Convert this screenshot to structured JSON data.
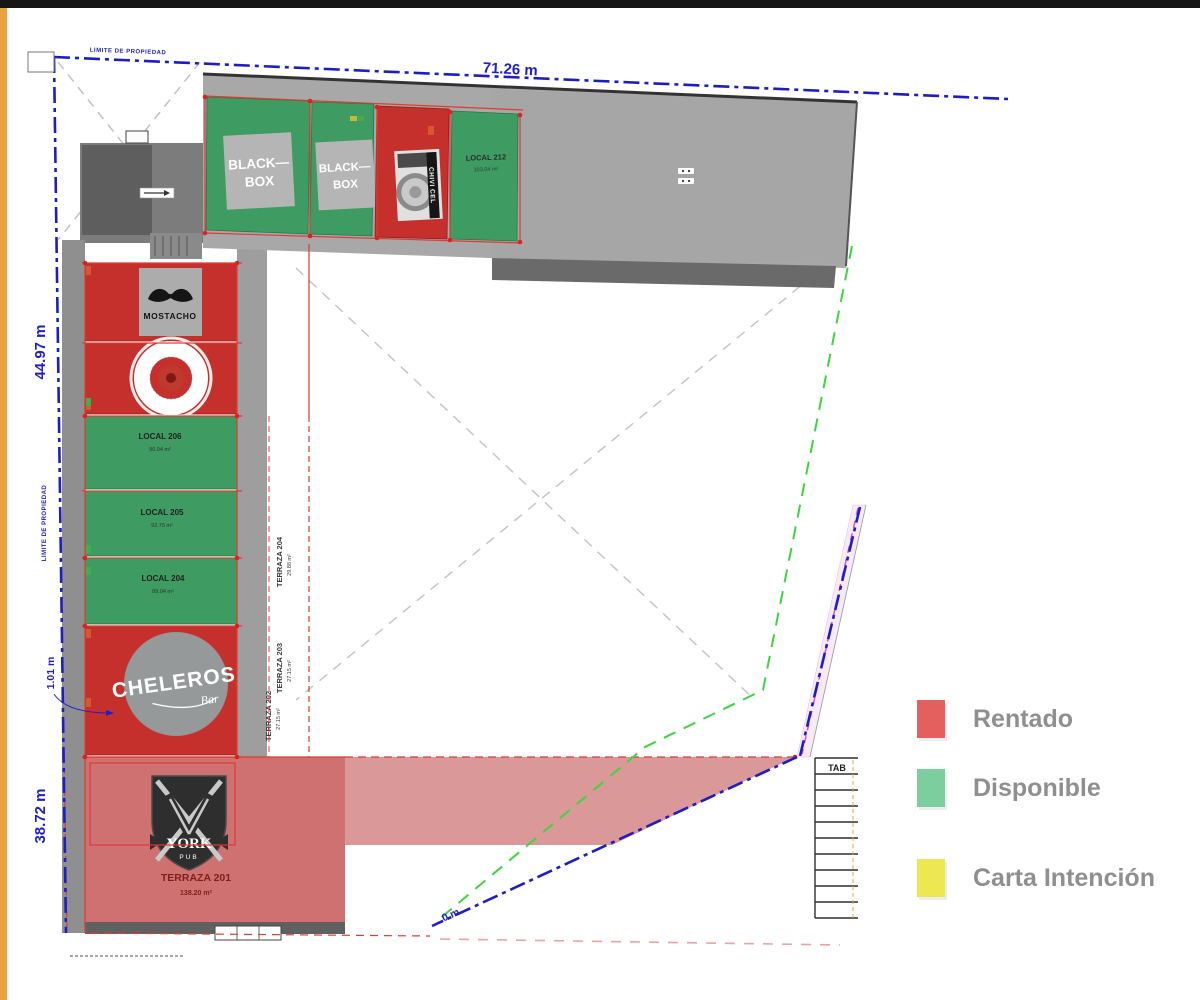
{
  "legend": {
    "items": [
      {
        "label": "Rentado",
        "color": "#E4605E"
      },
      {
        "label": "Disponible",
        "color": "#7CCE9F"
      },
      {
        "label": "Carta Intención",
        "color": "#EDE751"
      }
    ]
  },
  "plan": {
    "colors": {
      "rentado": "#C52F2C",
      "disponible": "#3E9B62",
      "terraza_rentado": "#CE7170",
      "terraza_band": "#D89392",
      "boundary_blue": "#2020C8",
      "restriction_green": "#3ED43E",
      "dim_red": "#E03A33",
      "orange_strip": "#E8A33D"
    },
    "dimensions": {
      "top": "71.26 m",
      "left_upper": "44.97 m",
      "left_mid": "1.01 m",
      "left_lower": "38.72 m",
      "bottom_partial": "0 m",
      "property_top": "LIMITE DE PROPIEDAD",
      "property_left": "LIMITE DE PROPIEDAD"
    },
    "top_row": {
      "blackbox1_line1": "BLACK—",
      "blackbox1_line2": "BOX",
      "blackbox2_line1": "BLACK—",
      "blackbox2_line2": "BOX",
      "chivicel": "CHIVI CEL",
      "local212_label": "LOCAL 212",
      "local212_area": "103.04 m²"
    },
    "left_column": {
      "mostacho": "MOSTACHO",
      "local206_label": "LOCAL 206",
      "local206_area": "96.04 m²",
      "local205_label": "LOCAL 205",
      "local205_area": "92.75 m²",
      "local204_label": "LOCAL 204",
      "local204_area": "89.04 m²",
      "cheleros": "CHELEROS",
      "cheleros_sub": "Bar",
      "york": "YORK",
      "york_sub": "PUB",
      "terraza201_label": "TERRAZA 201",
      "terraza201_area": "138.20 m²"
    },
    "terrazas": {
      "t204_label": "TERRAZA 204",
      "t204_area": "29.88 m²",
      "t203_label": "TERRAZA 203",
      "t203_area": "27.15 m²",
      "t202_label": "TERRAZA 202",
      "t202_area": "27.15 m²"
    },
    "table_header": "TAB"
  }
}
